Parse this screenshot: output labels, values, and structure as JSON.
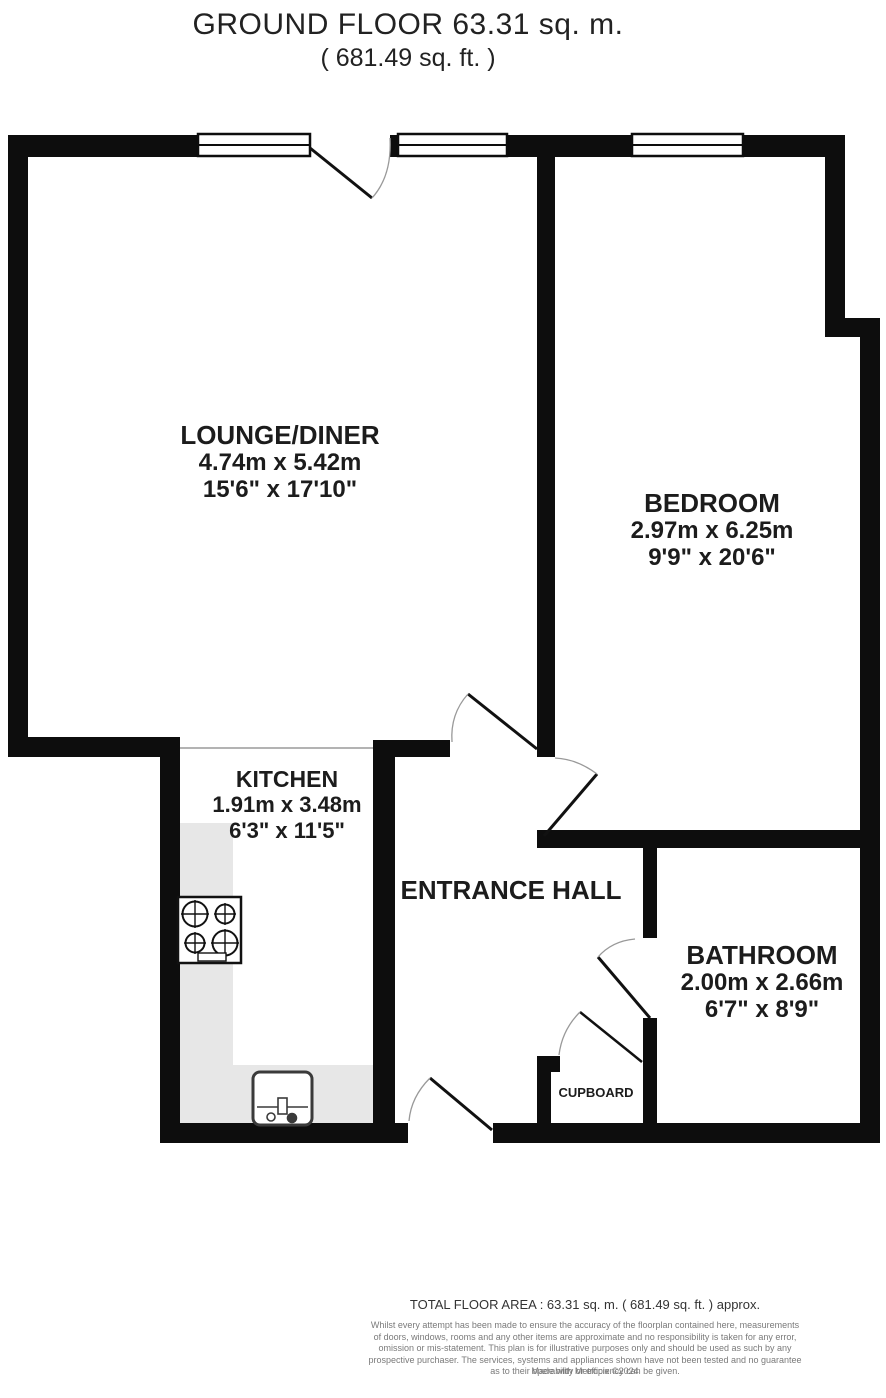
{
  "title": {
    "line1": "GROUND FLOOR 63.31 sq. m.",
    "line2": "( 681.49 sq. ft. )"
  },
  "rooms": [
    {
      "name": "LOUNGE/DINER",
      "dims_m": "4.74m x 5.42m",
      "dims_ft": "15'6\" x 17'10\""
    },
    {
      "name": "BEDROOM",
      "dims_m": "2.97m x 6.25m",
      "dims_ft": "9'9\" x 20'6\""
    },
    {
      "name": "KITCHEN",
      "dims_m": "1.91m x 3.48m",
      "dims_ft": "6'3\" x 11'5\""
    },
    {
      "name": "ENTRANCE HALL"
    },
    {
      "name": "BATHROOM",
      "dims_m": "2.00m x 2.66m",
      "dims_ft": "6'7\" x 8'9\""
    },
    {
      "name": "CUPBOARD"
    }
  ],
  "footer": {
    "total": "TOTAL FLOOR AREA : 63.31 sq. m. ( 681.49 sq. ft. ) approx.",
    "disclaimer_lines": [
      "Whilst every attempt has been made to ensure the accuracy of the floorplan contained here, measurements",
      "of doors, windows, rooms and any other items are approximate and no responsibility is taken for any error,",
      "omission or mis-statement. This plan is for illustrative purposes only and should be used as such by any",
      "prospective purchaser. The services, systems and appliances shown have not been tested and no guarantee",
      "as to their operability or efficiency can be given."
    ],
    "credit": "Made with Metropix ©2024"
  },
  "colors": {
    "wall": "#0d0d0d",
    "counter": "#e7e7e7",
    "door_arc": "#999999",
    "text": "#1c1c1c",
    "disclaimer_text": "#7a7a7a"
  }
}
